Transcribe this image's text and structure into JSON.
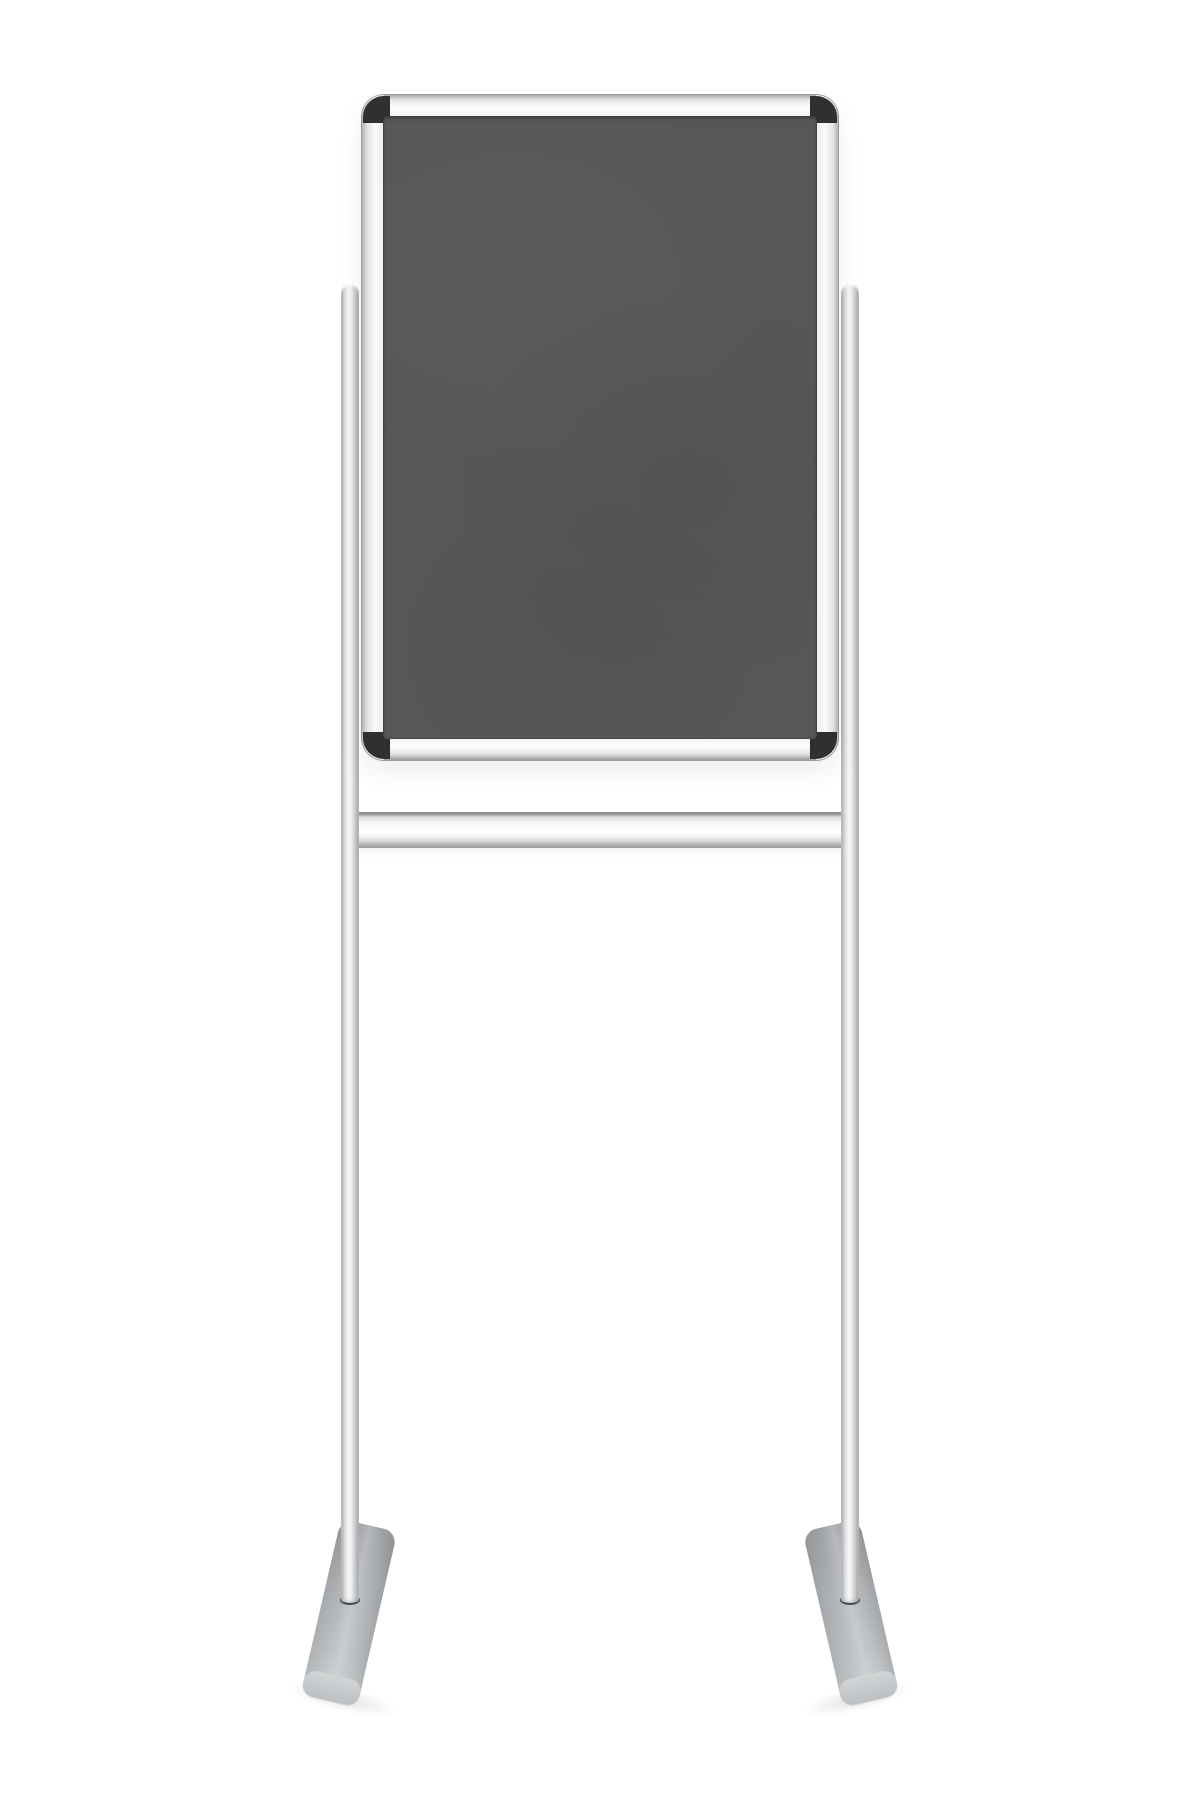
{
  "scene": {
    "description": "Product photo of a free-standing display notice board: a portrait-orientation dark grey felt pin board in a silver aluminium snap frame with dark corner caps, mounted between two slim aluminium poles joined by a horizontal crossbar, each pole ending in an angled grey T-foot on a white background.",
    "board_label": "dark grey felt notice board",
    "frame_label": "aluminium snap frame",
    "stand_label": "twin-pole stand with crossbar and T-feet",
    "colors": {
      "background": "#ffffff",
      "felt": "#565759",
      "felt_shade": "#4f5052",
      "frame_bright": "#fdfdfd",
      "frame_light": "#eceded",
      "frame_mid": "#d2d3d5",
      "frame_dark": "#aaabad",
      "frame_outline": "#9b9c9e",
      "corner_cap": "#2f3032",
      "pole_bright": "#f6f7f7",
      "pole_mid": "#d8d9db",
      "pole_dark": "#a2a3a5",
      "crossbar_bright": "#fbfbfc",
      "crossbar_edge": "#98999b",
      "foot_body": "#b2b5b8",
      "foot_light": "#c8cbcd",
      "foot_dark": "#9ea1a4",
      "ring": "#47484a"
    }
  }
}
